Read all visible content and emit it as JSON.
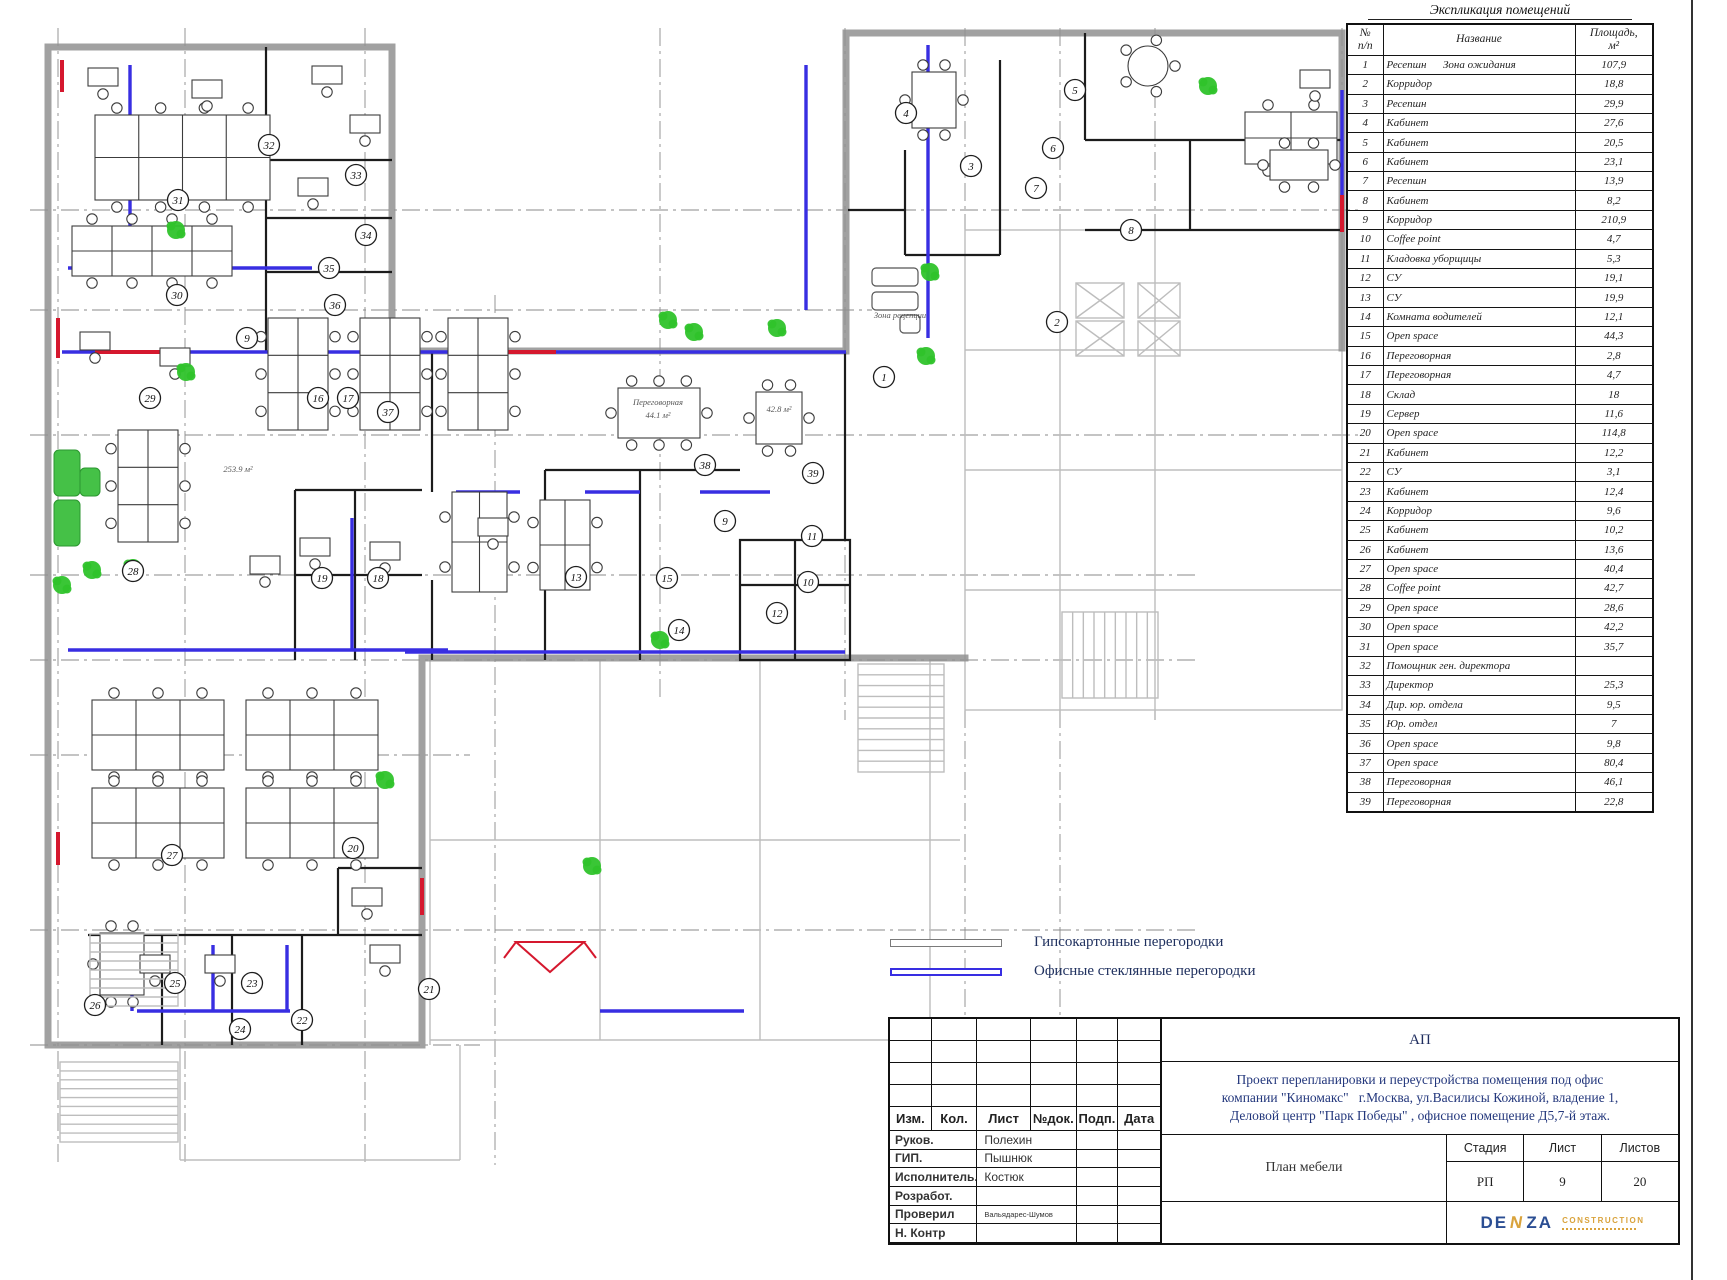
{
  "explication": {
    "title": "Экспликация помещений",
    "columns": {
      "num": "№\nп/п",
      "name": "Название",
      "area": "Площадь,\nм²"
    },
    "rows": [
      {
        "n": "1",
        "name": "Ресепшн      Зона ожидания",
        "area": "107,9"
      },
      {
        "n": "2",
        "name": "Корридор",
        "area": "18,8"
      },
      {
        "n": "3",
        "name": "Ресепшн",
        "area": "29,9"
      },
      {
        "n": "4",
        "name": "Кабинет",
        "area": "27,6"
      },
      {
        "n": "5",
        "name": "Кабинет",
        "area": "20,5"
      },
      {
        "n": "6",
        "name": "Кабинет",
        "area": "23,1"
      },
      {
        "n": "7",
        "name": "Ресепшн",
        "area": "13,9"
      },
      {
        "n": "8",
        "name": "Кабинет",
        "area": "8,2"
      },
      {
        "n": "9",
        "name": "Корридор",
        "area": "210,9"
      },
      {
        "n": "10",
        "name": "Coffee point",
        "area": "4,7"
      },
      {
        "n": "11",
        "name": "Кладовка уборщицы",
        "area": "5,3"
      },
      {
        "n": "12",
        "name": "СУ",
        "area": "19,1"
      },
      {
        "n": "13",
        "name": "СУ",
        "area": "19,9"
      },
      {
        "n": "14",
        "name": "Комната водителей",
        "area": "12,1"
      },
      {
        "n": "15",
        "name": "Open space",
        "area": "44,3"
      },
      {
        "n": "16",
        "name": "Переговорная",
        "area": "2,8"
      },
      {
        "n": "17",
        "name": "Переговорная",
        "area": "4,7"
      },
      {
        "n": "18",
        "name": "Склад",
        "area": "18"
      },
      {
        "n": "19",
        "name": "Сервер",
        "area": "11,6"
      },
      {
        "n": "20",
        "name": "Open space",
        "area": "114,8"
      },
      {
        "n": "21",
        "name": "Кабинет",
        "area": "12,2"
      },
      {
        "n": "22",
        "name": "СУ",
        "area": "3,1"
      },
      {
        "n": "23",
        "name": "Кабинет",
        "area": "12,4"
      },
      {
        "n": "24",
        "name": "Корридор",
        "area": "9,6"
      },
      {
        "n": "25",
        "name": "Кабинет",
        "area": "10,2"
      },
      {
        "n": "26",
        "name": "Кабинет",
        "area": "13,6"
      },
      {
        "n": "27",
        "name": "Open space",
        "area": "40,4"
      },
      {
        "n": "28",
        "name": "Coffee point",
        "area": "42,7"
      },
      {
        "n": "29",
        "name": "Open space",
        "area": "28,6"
      },
      {
        "n": "30",
        "name": "Open space",
        "area": "42,2"
      },
      {
        "n": "31",
        "name": "Open space",
        "area": "35,7"
      },
      {
        "n": "32",
        "name": "Помощник ген. директора",
        "area": ""
      },
      {
        "n": "33",
        "name": "Директор",
        "area": "25,3"
      },
      {
        "n": "34",
        "name": "Дир. юр. отдела",
        "area": "9,5"
      },
      {
        "n": "35",
        "name": "Юр. отдел",
        "area": "7"
      },
      {
        "n": "36",
        "name": "Open space",
        "area": "9,8"
      },
      {
        "n": "37",
        "name": "Open space",
        "area": "80,4"
      },
      {
        "n": "38",
        "name": "Переговорная",
        "area": "46,1"
      },
      {
        "n": "39",
        "name": "Переговорная",
        "area": "22,8"
      }
    ]
  },
  "legend": {
    "items": [
      {
        "label": "Гипсокартонные перегородки",
        "color": "#7a7a7a",
        "thickness": 1.6
      },
      {
        "label": "Офисные стеклянные перегородки",
        "color": "#382ee2",
        "thickness": 2.4
      }
    ]
  },
  "stamp": {
    "code": "АП",
    "project_title": "Проект перепланировки и переустройства помещения под офис\nкомпании \"Киномакс\"   г.Москва, ул.Василисы Кожиной, владение 1,\nДеловой центр \"Парк Победы\" , офисное помещение Д5,7-й этаж.",
    "sheet_name": "План мебели",
    "header_cells": [
      "Изм.",
      "Кол.",
      "Лист",
      "№док.",
      "Подп.",
      "Дата"
    ],
    "roles": [
      {
        "label": "Руков.",
        "name": "Полехин"
      },
      {
        "label": "ГИП.",
        "name": "Пышнюк"
      },
      {
        "label": "Исполнитель.",
        "name": "Костюк"
      },
      {
        "label": "Розработ.",
        "name": ""
      },
      {
        "label": "Проверил",
        "name": "Вальядарес-Шумов"
      },
      {
        "label": "Н. Контр",
        "name": ""
      }
    ],
    "stage": {
      "label": "Стадия",
      "value": "РП"
    },
    "sheet": {
      "label": "Лист",
      "value": "9"
    },
    "sheets": {
      "label": "Листов",
      "value": "20"
    },
    "logo": {
      "p1": "DE",
      "p2": "N",
      "p3": "ZA",
      "word": "CONSTRUCTION"
    }
  },
  "plan": {
    "colors": {
      "glass": "#382ee2",
      "red": "#d5182e",
      "plant": "#2fc32b"
    },
    "markers": [
      {
        "n": "1",
        "x": 884,
        "y": 377
      },
      {
        "n": "2",
        "x": 1057,
        "y": 322
      },
      {
        "n": "3",
        "x": 971,
        "y": 166
      },
      {
        "n": "4",
        "x": 906,
        "y": 113
      },
      {
        "n": "5",
        "x": 1075,
        "y": 90
      },
      {
        "n": "6",
        "x": 1053,
        "y": 148
      },
      {
        "n": "7",
        "x": 1036,
        "y": 188
      },
      {
        "n": "8",
        "x": 1131,
        "y": 230
      },
      {
        "n": "9",
        "x": 247,
        "y": 338
      },
      {
        "n": "9",
        "x": 725,
        "y": 521
      },
      {
        "n": "10",
        "x": 808,
        "y": 582
      },
      {
        "n": "11",
        "x": 812,
        "y": 536
      },
      {
        "n": "12",
        "x": 777,
        "y": 613
      },
      {
        "n": "13",
        "x": 576,
        "y": 577
      },
      {
        "n": "14",
        "x": 679,
        "y": 630
      },
      {
        "n": "15",
        "x": 667,
        "y": 578
      },
      {
        "n": "16",
        "x": 318,
        "y": 398
      },
      {
        "n": "17",
        "x": 348,
        "y": 398
      },
      {
        "n": "18",
        "x": 378,
        "y": 578
      },
      {
        "n": "19",
        "x": 322,
        "y": 578
      },
      {
        "n": "20",
        "x": 353,
        "y": 848
      },
      {
        "n": "21",
        "x": 429,
        "y": 989
      },
      {
        "n": "22",
        "x": 302,
        "y": 1020
      },
      {
        "n": "23",
        "x": 252,
        "y": 983
      },
      {
        "n": "24",
        "x": 240,
        "y": 1029
      },
      {
        "n": "25",
        "x": 175,
        "y": 983
      },
      {
        "n": "26",
        "x": 95,
        "y": 1005
      },
      {
        "n": "27",
        "x": 172,
        "y": 855
      },
      {
        "n": "28",
        "x": 133,
        "y": 571
      },
      {
        "n": "29",
        "x": 150,
        "y": 398
      },
      {
        "n": "30",
        "x": 177,
        "y": 295
      },
      {
        "n": "31",
        "x": 178,
        "y": 200
      },
      {
        "n": "32",
        "x": 269,
        "y": 145
      },
      {
        "n": "33",
        "x": 356,
        "y": 175
      },
      {
        "n": "34",
        "x": 366,
        "y": 235
      },
      {
        "n": "35",
        "x": 329,
        "y": 268
      },
      {
        "n": "36",
        "x": 335,
        "y": 305
      },
      {
        "n": "37",
        "x": 388,
        "y": 412
      },
      {
        "n": "38",
        "x": 705,
        "y": 465
      },
      {
        "n": "39",
        "x": 813,
        "y": 473
      }
    ],
    "labels": [
      {
        "t": "Переговорная",
        "x": 658,
        "y": 405
      },
      {
        "t": "44.1 м²",
        "x": 658,
        "y": 418
      },
      {
        "t": "42.8 м²",
        "x": 779,
        "y": 412
      },
      {
        "t": "253.9 м²",
        "x": 238,
        "y": 472
      },
      {
        "t": "Зона рецепции",
        "x": 900,
        "y": 318
      }
    ],
    "furniture": [
      {
        "t": "bank",
        "x": 95,
        "y": 115,
        "w": 175,
        "h": 85
      },
      {
        "t": "bank",
        "x": 72,
        "y": 226,
        "w": 160,
        "h": 50
      },
      {
        "t": "bank",
        "x": 118,
        "y": 430,
        "w": 60,
        "h": 112
      },
      {
        "t": "bank",
        "x": 268,
        "y": 318,
        "w": 60,
        "h": 112
      },
      {
        "t": "bank",
        "x": 360,
        "y": 318,
        "w": 60,
        "h": 112
      },
      {
        "t": "bank",
        "x": 448,
        "y": 318,
        "w": 60,
        "h": 112
      },
      {
        "t": "bank",
        "x": 452,
        "y": 492,
        "w": 55,
        "h": 100
      },
      {
        "t": "bank",
        "x": 540,
        "y": 500,
        "w": 50,
        "h": 90
      },
      {
        "t": "bank",
        "x": 92,
        "y": 700,
        "w": 132,
        "h": 70
      },
      {
        "t": "bank",
        "x": 246,
        "y": 700,
        "w": 132,
        "h": 70
      },
      {
        "t": "bank",
        "x": 92,
        "y": 788,
        "w": 132,
        "h": 70
      },
      {
        "t": "bank",
        "x": 246,
        "y": 788,
        "w": 132,
        "h": 70
      },
      {
        "t": "bank",
        "x": 1245,
        "y": 112,
        "w": 92,
        "h": 52
      },
      {
        "t": "meet",
        "x": 618,
        "y": 388,
        "w": 82,
        "h": 50
      },
      {
        "t": "meet",
        "x": 756,
        "y": 392,
        "w": 46,
        "h": 52
      },
      {
        "t": "meet",
        "x": 912,
        "y": 72,
        "w": 44,
        "h": 56
      },
      {
        "t": "meet",
        "x": 1270,
        "y": 150,
        "w": 58,
        "h": 30
      },
      {
        "t": "meet",
        "x": 100,
        "y": 933,
        "w": 44,
        "h": 62
      },
      {
        "t": "round",
        "x": 1148,
        "y": 66,
        "r": 20
      },
      {
        "t": "desk",
        "x": 88,
        "y": 68
      },
      {
        "t": "desk",
        "x": 192,
        "y": 80
      },
      {
        "t": "desk",
        "x": 312,
        "y": 66
      },
      {
        "t": "desk",
        "x": 350,
        "y": 115
      },
      {
        "t": "desk",
        "x": 298,
        "y": 178
      },
      {
        "t": "desk",
        "x": 80,
        "y": 332
      },
      {
        "t": "desk",
        "x": 160,
        "y": 348
      },
      {
        "t": "desk",
        "x": 300,
        "y": 538
      },
      {
        "t": "desk",
        "x": 250,
        "y": 556
      },
      {
        "t": "desk",
        "x": 370,
        "y": 542
      },
      {
        "t": "desk",
        "x": 478,
        "y": 518
      },
      {
        "t": "desk",
        "x": 140,
        "y": 955
      },
      {
        "t": "desk",
        "x": 205,
        "y": 955
      },
      {
        "t": "desk",
        "x": 352,
        "y": 888
      },
      {
        "t": "desk",
        "x": 370,
        "y": 945
      },
      {
        "t": "desk",
        "x": 1300,
        "y": 70
      },
      {
        "t": "sofa",
        "x": 54,
        "y": 450,
        "w": 26,
        "h": 46
      },
      {
        "t": "sofa",
        "x": 54,
        "y": 500,
        "w": 26,
        "h": 46
      },
      {
        "t": "sofa",
        "x": 80,
        "y": 468,
        "w": 20,
        "h": 28
      },
      {
        "t": "gsofa",
        "x": 872,
        "y": 268,
        "w": 46,
        "h": 18
      },
      {
        "t": "gsofa",
        "x": 872,
        "y": 292,
        "w": 46,
        "h": 18
      },
      {
        "t": "gsofa",
        "x": 900,
        "y": 315,
        "w": 20,
        "h": 18
      }
    ],
    "plants": [
      {
        "x": 176,
        "y": 230
      },
      {
        "x": 186,
        "y": 372
      },
      {
        "x": 62,
        "y": 585
      },
      {
        "x": 92,
        "y": 570
      },
      {
        "x": 133,
        "y": 568
      },
      {
        "x": 385,
        "y": 780
      },
      {
        "x": 668,
        "y": 320
      },
      {
        "x": 694,
        "y": 332
      },
      {
        "x": 777,
        "y": 328
      },
      {
        "x": 930,
        "y": 272
      },
      {
        "x": 926,
        "y": 356
      },
      {
        "x": 660,
        "y": 640
      },
      {
        "x": 592,
        "y": 866
      },
      {
        "x": 1208,
        "y": 86
      }
    ],
    "stairs": [
      {
        "x": 60,
        "y": 1062,
        "w": 118,
        "h": 80,
        "n": 9,
        "dir": "h"
      },
      {
        "x": 90,
        "y": 934,
        "w": 88,
        "h": 72,
        "n": 8,
        "dir": "h"
      },
      {
        "x": 858,
        "y": 664,
        "w": 86,
        "h": 108,
        "n": 10,
        "dir": "h"
      },
      {
        "x": 1062,
        "y": 612,
        "w": 96,
        "h": 86,
        "n": 9,
        "dir": "v"
      }
    ],
    "elevators": [
      {
        "x": 1076,
        "y": 283,
        "w": 48,
        "h": 35
      },
      {
        "x": 1076,
        "y": 321,
        "w": 48,
        "h": 35
      },
      {
        "x": 1138,
        "y": 283,
        "w": 42,
        "h": 35
      },
      {
        "x": 1138,
        "y": 321,
        "w": 42,
        "h": 35
      }
    ]
  }
}
